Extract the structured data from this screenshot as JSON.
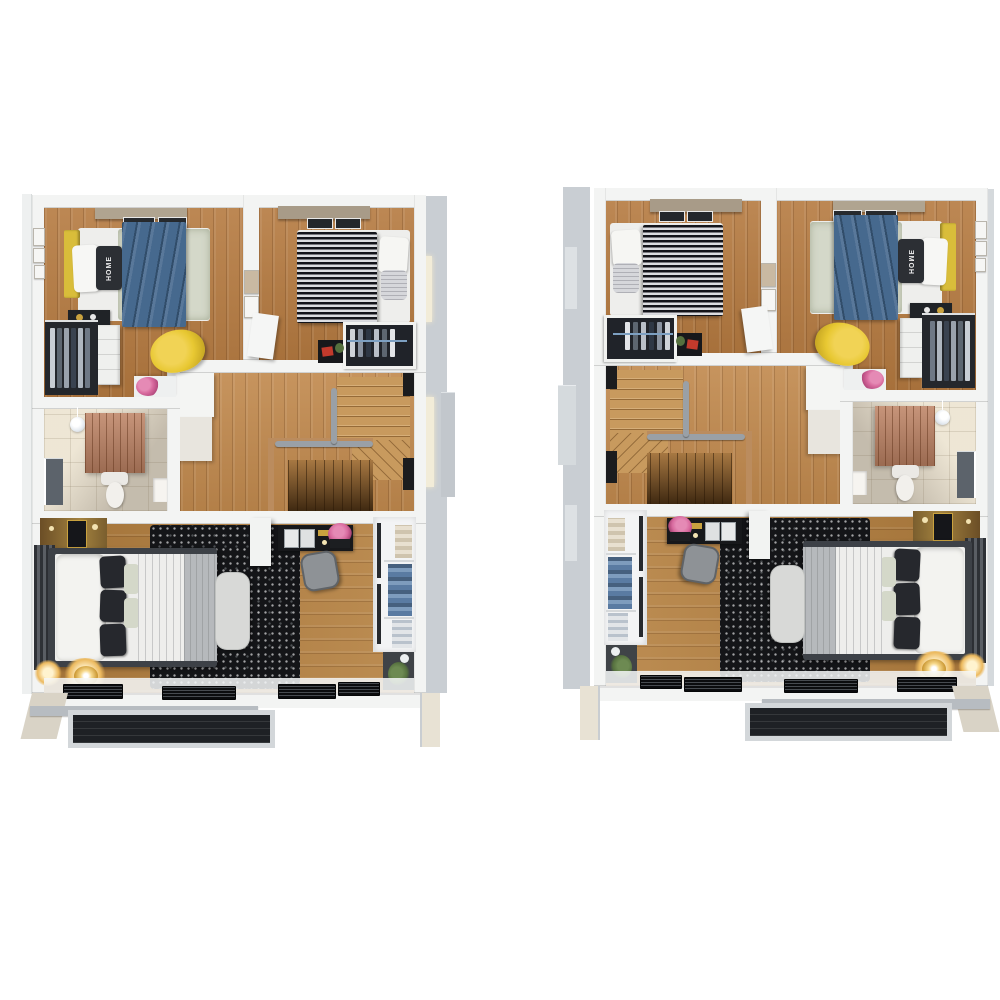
{
  "scene": {
    "type": "3d-floor-plan-render",
    "views": [
      {
        "id": "floor-plan-left",
        "label": "upper floor plan (left view)"
      },
      {
        "id": "floor-plan-right",
        "label": "upper floor plan (mirrored right view)"
      }
    ],
    "rooms": [
      "bedroom-1",
      "bedroom-2",
      "bathroom",
      "hall-stairs",
      "master-bedroom",
      "balcony"
    ]
  },
  "bedroom": {
    "pillow_text": "HOME"
  },
  "colors": {
    "background": "#ffffff",
    "wall": "#f3f4f3",
    "wall_side_gray": "#c9ced3",
    "wall_trim_cream": "#ece6d8",
    "wood_bedroom": "#b57a40",
    "wood_hall": "#c28a4e",
    "wood_master": "#b5803f",
    "stair_wood": "#c89a5e",
    "stair_descent": "#8a5a26",
    "rug_black": "#141518",
    "bed_frame": "#3d4147",
    "duvet_white": "#eeeeec",
    "pillow_dark": "#26282d",
    "blanket_blue": "#46698e",
    "duvet_sage": "#d4d8c9",
    "headboard_yellow": "#d9bd3a",
    "chair_yellow": "#e8c832",
    "bath_tile": "#cfc6b6",
    "sauna_wood": "#bd8263",
    "toilet_white": "#f2f0ec",
    "balcony_floor": "#1e2125",
    "bench_gray": "#d8d9d7",
    "closet_white": "#f3f4f5",
    "flower_pink": "#d86a9e",
    "plant_green": "#55703e",
    "lamp_gold": "#c9952f",
    "desk_black": "#17181b"
  }
}
